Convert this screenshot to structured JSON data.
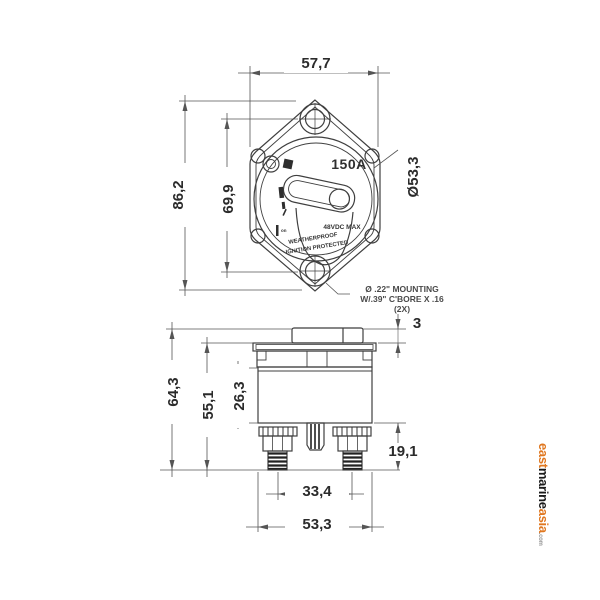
{
  "drawing": {
    "top_view": {
      "rating_label": "150A",
      "voltage_label": "48VDC MAX",
      "weatherproof_label": "WEATHERPROOF",
      "ignition_label": "IGNITION PROTECTED",
      "on_label": "on",
      "dim_flange_width": "57,7",
      "dim_flange_height": "86,2",
      "dim_hole_spacing": "69,9",
      "dim_face_diameter": "Ø53,3",
      "mounting_note_line1": "Ø .22\" MOUNTING",
      "mounting_note_line2": "W/.39\" C'BORE X .16",
      "mounting_note_line3": "(2X)"
    },
    "side_view": {
      "dim_knob_height": "3",
      "dim_total_height": "64,3",
      "dim_flange_to_base_height": "55,1",
      "dim_body_height": "26,3",
      "dim_stud_height": "19,1",
      "dim_stud_spacing": "33,4",
      "dim_body_width": "53,3"
    }
  },
  "watermark": {
    "part1": "east",
    "part2": "marine",
    "part3": "asia",
    "suffix": ".com",
    "orange": "#e0771f",
    "dark": "#1b1b1b",
    "gray": "#9a9a9a"
  },
  "colors": {
    "object_line": "#3f3f3f",
    "dim_line": "#555555",
    "text": "#2b2b2b",
    "background": "#ffffff"
  }
}
